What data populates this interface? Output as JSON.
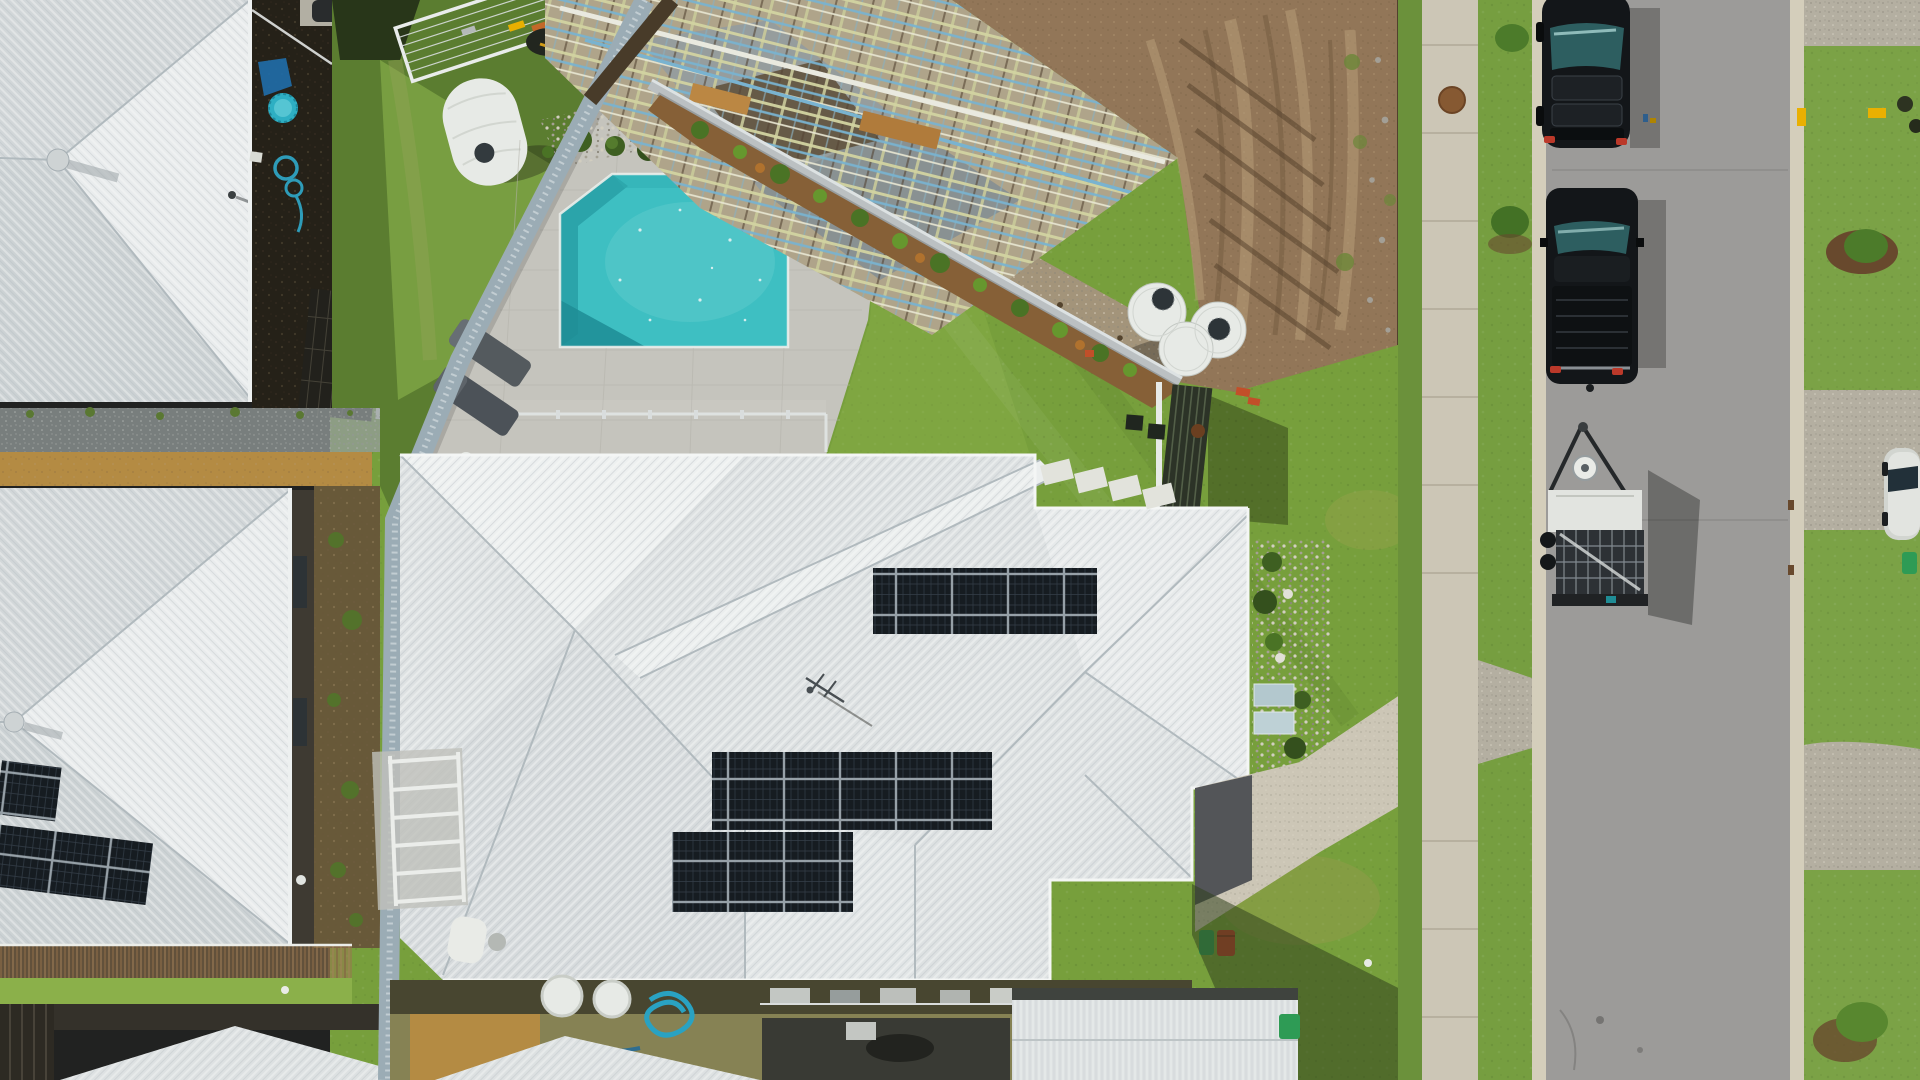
{
  "meta": {
    "type": "aerial-drone-photograph",
    "description": "Top-down aerial view of a suburban street: large house with white corrugated hip roof and rooftop solar arrays, backyard swimming pool with paver surround, neighbouring lot under construction with timber and blue-steel roof framing on bare earth, round white water tanks, black SUV, black ute, box trailer and white car along a grey asphalt road with concrete footpath, kerbs and green nature strips.",
    "visible_text": "none"
  },
  "palette": {
    "roof_light": "#e4e7e9",
    "roof_mid": "#d8dcdf",
    "roof_dark_facet": "#cdd2d6",
    "pool_water": "#3fc4c8",
    "pool_step": "#2ba7ae",
    "pool_shadow": "#1e8f99",
    "pavers": "#cbc9c3",
    "lawn": "#7aa33d",
    "lawn_light": "#8fb44c",
    "lawn_dark": "#5d7f31",
    "dirt": "#96785a",
    "dirt_light": "#b99d79",
    "dirt_dark": "#7a5f44",
    "gravel": "#a8977d",
    "road": "#a09e9d",
    "concrete": "#d2cbbb",
    "curb": "#dad3c1",
    "aggregate": "#b9b3a6",
    "fence_gray": "#9fb0ba",
    "fence_timber": "#4a3b2a",
    "timber_frame": "#d8d8a6",
    "steel_blue": "#7cb7d6",
    "slab_gray": "#9aa0a2",
    "solar_panel": "#161b22",
    "tank_white": "#eef0ed",
    "vehicle_black": "#131519",
    "glass_teal": "#2e5f63",
    "trailer_white": "#e9eae7",
    "trailer_cage": "#2e3136",
    "bin_green": "#2f9e57",
    "bin_red": "#c0392b",
    "flag_orange": "#d84315",
    "yellow_paint": "#f0b400",
    "mulch": "#8a6238",
    "shrub": "#4c7526",
    "deck_timber": "#9c7a52",
    "dry_grass": "#b98e45",
    "backyard_shade": "#262018",
    "clamshell_blue": "#2fb3c9"
  },
  "scene": {
    "objects": [
      {
        "name": "house-top-left",
        "desc": "white corrugated hip roof with whirlybird vent and roof pipe"
      },
      {
        "name": "house-mid-left",
        "desc": "white corrugated hip roof, dark east wall, two tilted solar arrays on lower facet"
      },
      {
        "name": "house-bottom-left",
        "desc": "roof edge behind timber deck and lawn strip, dark paling fence"
      },
      {
        "name": "main-house",
        "desc": "large white corrugated hip roof with valleys and raised ridge band",
        "solar_arrays": [
          {
            "name": "array-north",
            "layout": "5 x 2 landscape panels"
          },
          {
            "name": "array-mid",
            "layout": "5 x 2 landscape panels"
          },
          {
            "name": "array-low",
            "layout": "3 x 2 landscape panels"
          }
        ],
        "antenna": true
      },
      {
        "name": "swimming-pool",
        "desc": "turquoise pool with two cut corners and swim-out bench, light grey paver surround, frameless glass fence, two grey sun loungers, pebble bed with clipped shrubs"
      },
      {
        "name": "construction-site",
        "desc": "roof framing of pale timber trusses with blue steel battens over a concrete slab, bare earth with machine tracks, gravel strip, silt fence with orange flags beside the footpath"
      },
      {
        "name": "water-tanks",
        "desc": "three round white rainwater tanks near the boundary gate; white slimline tank in the neighbouring yard"
      },
      {
        "name": "boundary-fences",
        "desc": "light grey metal fences, dark timber fence, dark slat gate with white posts, white pool-fence panels"
      },
      {
        "name": "street",
        "desc": "grey asphalt road running north-south, concrete kerbs both sides, footpath with expansion joints and manhole cover, grass verges with shrubs and mulch rings, exposed-aggregate driveways, yellow paint marks"
      },
      {
        "name": "vehicles",
        "items": [
          "black SUV parked at kerb",
          "black dual-cab ute",
          "galvanised box trailer with white front panel",
          "white car on driveway"
        ]
      },
      {
        "name": "backyard-items",
        "items": [
          "rotary clothesline with washing",
          "lawnmower",
          "blue clamshell paddling pool",
          "coiled blue pool hose",
          "green and red wheelie bins",
          "white pergola frame",
          "timber deck",
          "air-conditioning units along side wall"
        ]
      }
    ]
  }
}
